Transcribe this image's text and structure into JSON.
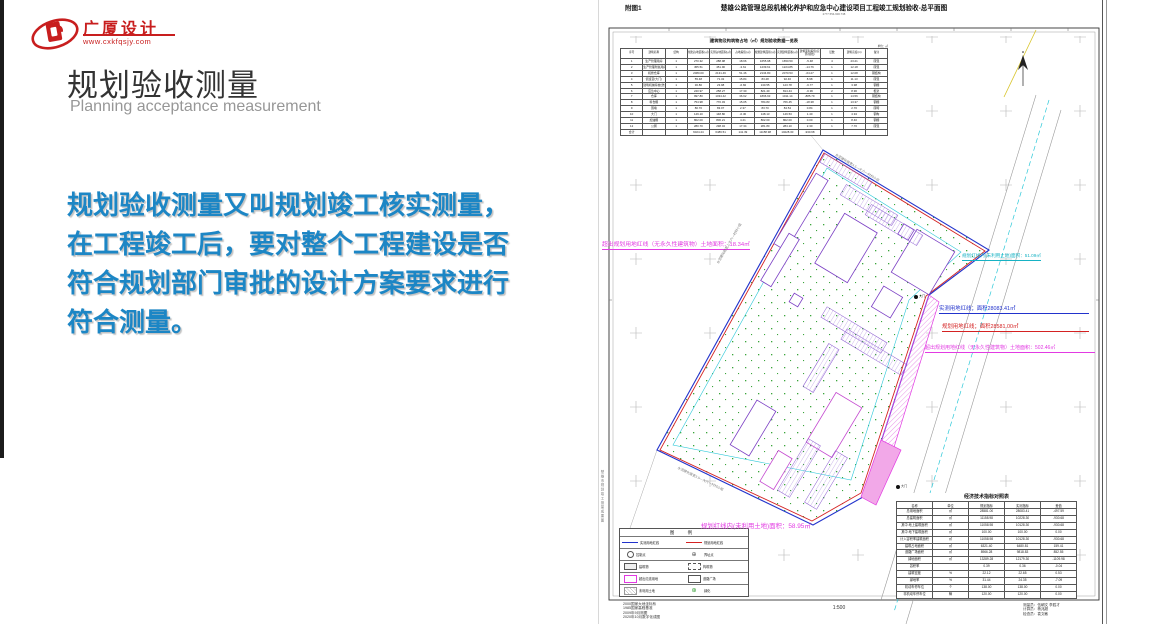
{
  "colors": {
    "accent_red": "#c81e1e",
    "intro_blue": "#1c86c5",
    "magenta": "#e23ae2",
    "cyan": "#17b2c4",
    "line_red": "#d42222",
    "line_blue": "#2233cc",
    "green": "#2a9a2a",
    "violet": "#7b3fc4"
  },
  "logo": {
    "name": "广厦设计",
    "url": "www.cxkfqsjy.com"
  },
  "header": {
    "title": "规划验收测量",
    "subtitle": "Planning acceptance measurement"
  },
  "intro": {
    "text": "规划验收测量又叫规划竣工核实测量，\n在工程竣工后，要对整个工程建设是否\n符合规划部门审批的设计方案要求进行\n符合测量。"
  },
  "drawing": {
    "figure_label": "附图1",
    "title": "楚雄公路管理总段机械化养护和应急中心建设项目工程竣工规划验收-总平面图",
    "doc_number": "2777.554-600.738",
    "annotations": {
      "left_magenta": "超出规划用地红线（无永久性建筑物）土地面积：18.34㎡",
      "cyan_right": "规划红线内(未利用土地)面积：51.09㎡",
      "blue_measured": "实测用地红线；面积28083.41㎡",
      "red_planned": "规划用地红线；面积28581.00㎡",
      "magenta_right": "超出规划用地红线（无永久性建筑物）土地面积：502.46㎡",
      "magenta_bottom": "规划红线内(未利用土地)面积：58.95㎡"
    },
    "road_labels": {
      "top": "水泥硬化路宽4.5—大六一村村小组",
      "bottom": "水泥硬化路宽3.5—大六一村村小组",
      "left": "水泥硬化路宽上大六—村村小组"
    },
    "gate_labels": {
      "east": "大门",
      "south": "大门"
    },
    "buildings_table": {
      "title": "建筑物及构筑物占地（㎡）规划验收数据一览表",
      "unit_note": "单位：㎡",
      "headers": [
        "序号",
        "建筑名称",
        "结构",
        "规划占地面积(㎡)",
        "实测占地面积(㎡)",
        "占地差值(㎡)",
        "规划建筑面积(㎡)",
        "实测建筑面积(㎡)",
        "建筑面积差值(实测-规划)",
        "层数",
        "建筑高度(m)",
        "备注"
      ],
      "rows": [
        [
          "1",
          "生产管理用房",
          "1",
          "270.32",
          "288.98",
          "18.66",
          "1655.98",
          "1650.50",
          "-5.48",
          "4",
          "23.21",
          "砖混"
        ],
        [
          "2",
          "生产管理附属用房",
          "1",
          "455.51",
          "451.90",
          "-3.61",
          "1239.61",
          "1224.85",
          "-14.76",
          "1",
          "12.18",
          "砖混"
        ],
        [
          "3",
          "机修仓库",
          "1",
          "2080.00",
          "2131.46",
          "51.46",
          "2134.80",
          "2070.53",
          "-64.27",
          "1",
          "12.08",
          "钢结构"
        ],
        [
          "4",
          "值班室(大门)",
          "1",
          "55.48",
          "71.32",
          "15.84",
          "83.48",
          "92.46",
          "8.98",
          "1",
          "11.13",
          "砖混"
        ],
        [
          "5",
          "建筑机械停放(洗车)棚",
          "1",
          "30.80",
          "23.98",
          "-6.82",
          "130.55",
          "123.78",
          "-6.77",
          "1",
          "3.98",
          "钢棚"
        ],
        [
          "6",
          "应急中心",
          "1",
          "240.97",
          "258.27",
          "17.30",
          "821.40",
          "814.44",
          "-6.96",
          "2",
          "8.96",
          "框架"
        ],
        [
          "7",
          "仓库",
          "1",
          "997.80",
          "1034.42",
          "36.62",
          "1896.93",
          "1011.14",
          "-885.79",
          "1",
          "14.56",
          "钢结构"
        ],
        [
          "8",
          "料仓棚",
          "1",
          "754.98",
          "770.03",
          "15.05",
          "784.83",
          "766.45",
          "-18.38",
          "1",
          "13.37",
          "钢棚"
        ],
        [
          "9",
          "围墙",
          "1",
          "80.70",
          "83.07",
          "2.37",
          "83.70",
          "84.54",
          "0.84",
          "1",
          "2.70",
          "砖砌"
        ],
        [
          "10",
          "大门",
          "1",
          "149.10",
          "148.80",
          "-0.30",
          "148.13",
          "149.53",
          "1.40",
          "1",
          "4.94",
          "钢构"
        ],
        [
          "11",
          "加油棚",
          "1",
          "802.00",
          "806.21",
          "4.21",
          "802.00",
          "802.00",
          "0.00",
          "1",
          "8.40",
          "钢棚"
        ],
        [
          "12",
          "公厕",
          "1",
          "280.70",
          "298.04",
          "17.34",
          "281.80",
          "284.10",
          "2.30",
          "1",
          "7.70",
          "砖混"
        ],
        [
          "合计",
          "",
          "",
          "6024.44",
          "6486.51",
          "141.39",
          "11158.98",
          "10228.30",
          "-930.68",
          "",
          "",
          ""
        ]
      ]
    },
    "econ_table": {
      "title": "经济技术指标对照表",
      "headers": [
        "名称",
        "单位",
        "规划指标",
        "实测指标",
        "差值"
      ],
      "rows": [
        [
          "总用地面积",
          "㎡",
          "28581.00",
          "28083.41",
          "-497.59"
        ],
        [
          "总建筑面积",
          "㎡",
          "11158.98",
          "10228.30",
          "-930.68"
        ],
        [
          "其中 地上建筑面积",
          "㎡",
          "11058.98",
          "10128.30",
          "-930.68"
        ],
        [
          "其中 地下建筑面积",
          "㎡",
          "100.00",
          "100.00",
          "0.00"
        ],
        [
          "计入容积率建筑面积",
          "㎡",
          "11058.98",
          "10128.30",
          "-930.68"
        ],
        [
          "建筑占地面积",
          "㎡",
          "6321.40",
          "6480.81",
          "159.41"
        ],
        [
          "道路广场面积",
          "㎡",
          "8966.28",
          "9818.83",
          "852.55"
        ],
        [
          "绿地面积",
          "㎡",
          "13289.28",
          "12179.30",
          "-1109.98"
        ],
        [
          "容积率",
          "",
          "0.39",
          "0.36",
          "-0.04"
        ],
        [
          "建筑密度",
          "%",
          "22.12",
          "22.65",
          "0.53"
        ],
        [
          "绿地率",
          "%",
          "31.44",
          "24.35",
          "-7.09"
        ],
        [
          "机动车停车位",
          "个",
          "138.00",
          "138.00",
          "0.00"
        ],
        [
          "非机动车停车位",
          "辆",
          "120.00",
          "120.00",
          "0.00"
        ]
      ]
    },
    "legend": {
      "title": "图 例",
      "items": [
        {
          "symbol": "line-blue",
          "label": "实测用地红线"
        },
        {
          "symbol": "line-red",
          "label": "规划用地红线"
        },
        {
          "symbol": "circle",
          "label": "控制点"
        },
        {
          "symbol": "circle-cross",
          "label": "界址点"
        },
        {
          "symbol": "rect-gray",
          "label": "建筑物"
        },
        {
          "symbol": "rect-dashed",
          "label": "构筑物"
        },
        {
          "symbol": "rect-magenta",
          "label": "超出红线用地"
        },
        {
          "symbol": "rect-label",
          "label": "道路广场"
        },
        {
          "symbol": "hatch",
          "label": "未利用土地"
        },
        {
          "symbol": "tree",
          "label": "绿化"
        }
      ]
    },
    "footer": {
      "left_lines": [
        "2000国家大地坐标系",
        "1985国家高程基准",
        "2009年9月测图",
        "2020年10月数字化成图"
      ],
      "scale": "1:500",
      "right_lines": [
        "测量员：伍朝文 李胜才",
        "计算员：杨兆超",
        "检查员：袁文敏"
      ]
    },
    "side_note": "楚雄市规划竣工测量成果图"
  }
}
